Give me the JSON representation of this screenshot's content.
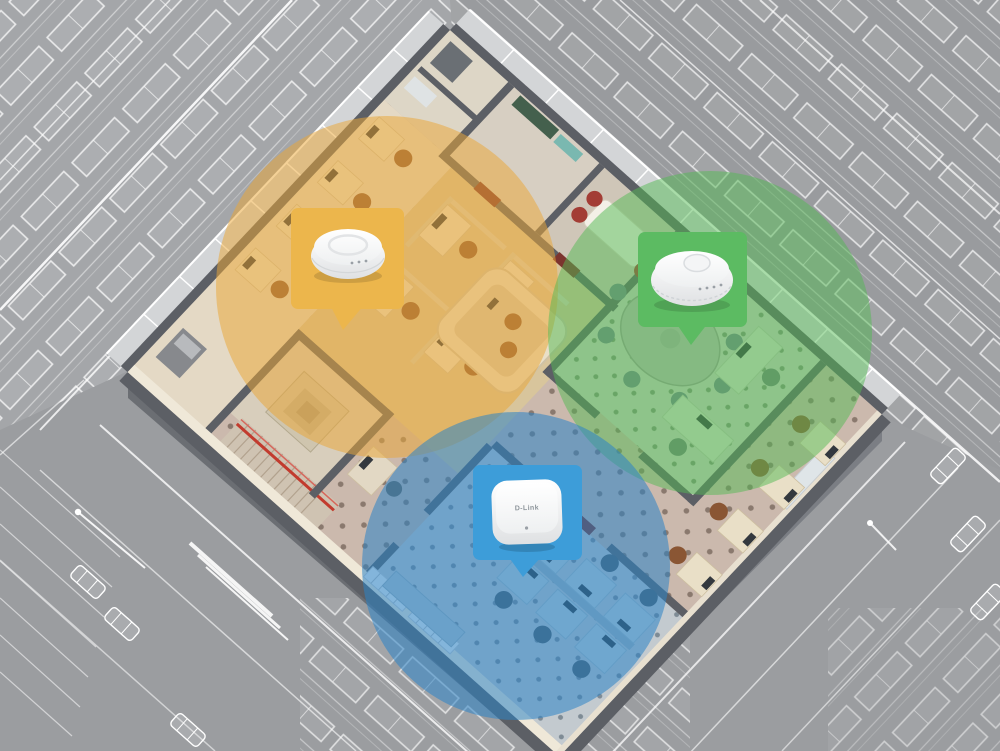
{
  "illustration": {
    "description": "3D cutaway office floor with three ceiling wireless access points and color-coded Wi-Fi coverage zones, surrounded by wireframe city buildings",
    "background_color": "#9b9da0",
    "wireframe_line_color": "#ffffff",
    "floor": {
      "wall_top_color": "#5c5f65",
      "carpet_color": "#cbb9ad",
      "wood_color": "#d8c59c",
      "beige_color": "#e4d9c5",
      "green_room_floor": "#c9cfc0",
      "blue_room_floor": "#c3cacf"
    },
    "coverage_zones": [
      {
        "id": "zone-yellow",
        "color": "#eaa637"
      },
      {
        "id": "zone-green",
        "color": "#53b953"
      },
      {
        "id": "zone-blue",
        "color": "#2b83c6"
      }
    ],
    "callouts": [
      {
        "id": "callout-yellow",
        "color": "#ecb64c",
        "device": "round ceiling access point"
      },
      {
        "id": "callout-green",
        "color": "#5cbb62",
        "device": "large round ceiling access point"
      },
      {
        "id": "callout-blue",
        "color": "#3d9dd9",
        "device": "square ceiling access point",
        "brand_label": "D-Link"
      }
    ]
  }
}
